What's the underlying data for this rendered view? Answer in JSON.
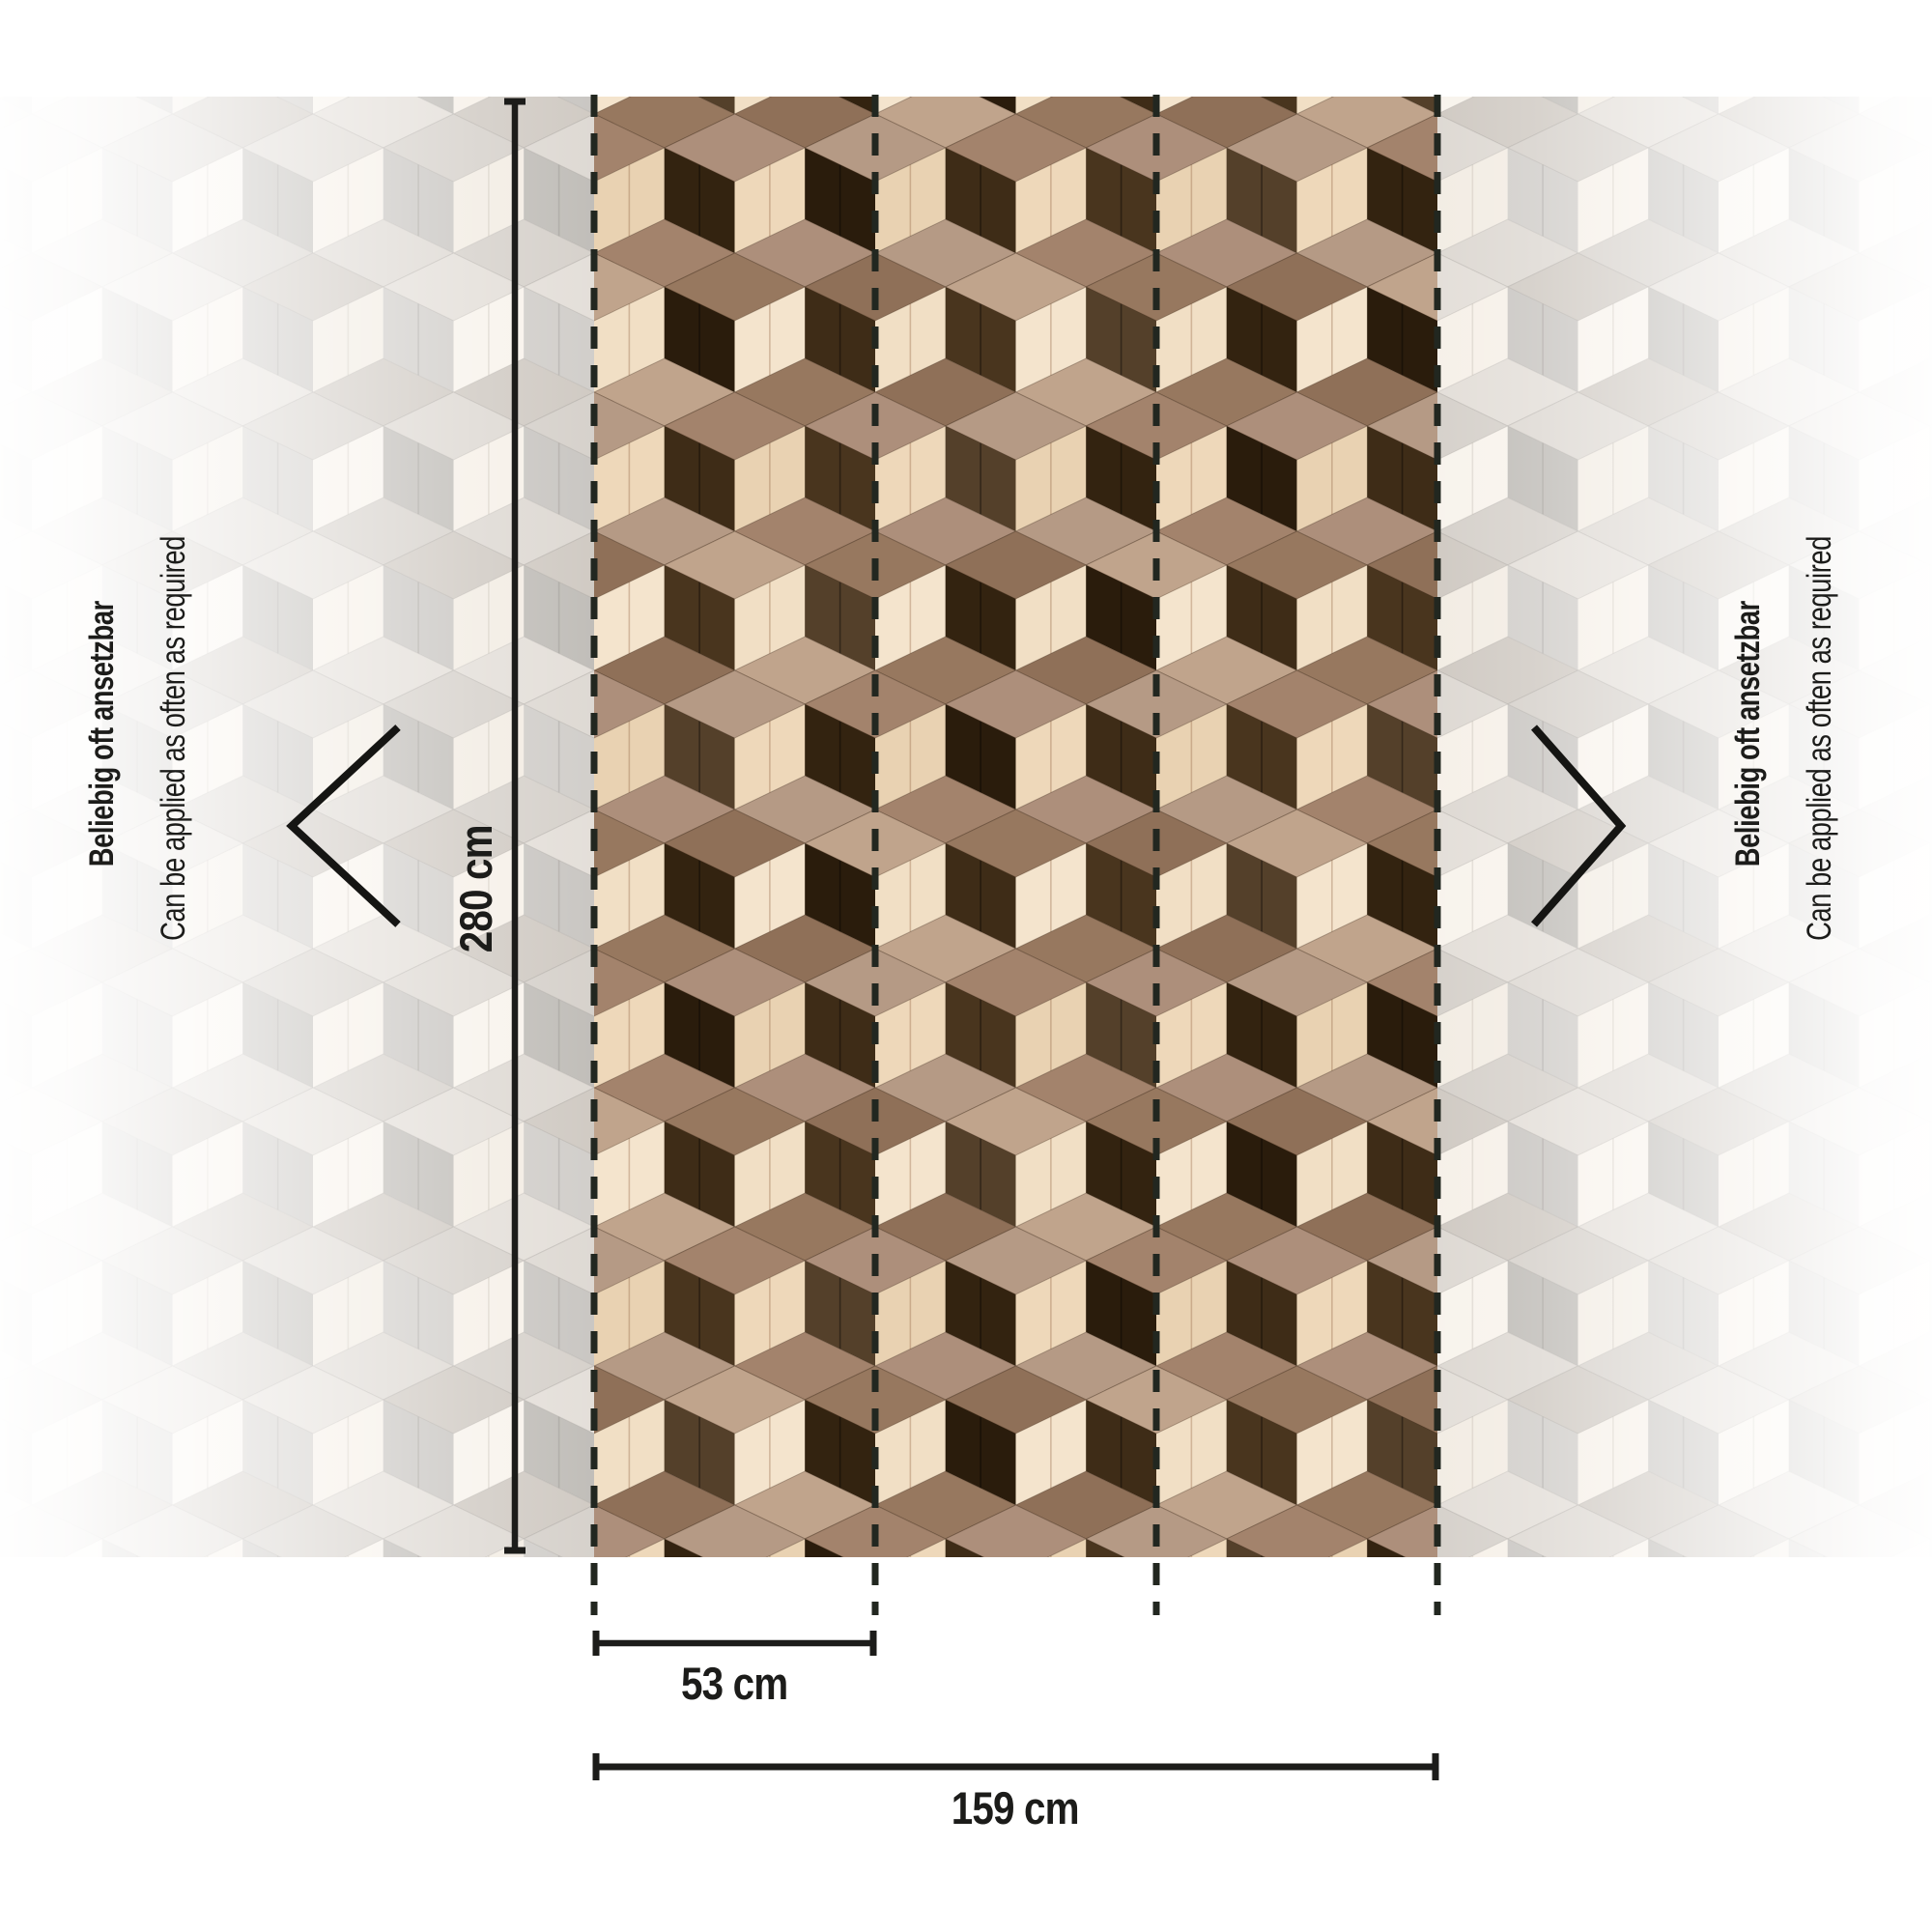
{
  "diagram": {
    "height_label": "280 cm",
    "panel_width_label": "53 cm",
    "total_width_label": "159 cm",
    "note_de": "Beliebig oft ansetzbar",
    "note_en": "Can be applied as often as required"
  },
  "icons": {
    "left": "chevron-left-icon",
    "right": "chevron-right-icon"
  },
  "colors": {
    "ink": "#1c1c1a",
    "dash": "#222720",
    "colored": {
      "tops": [
        "#a3836c",
        "#97785f",
        "#ad8f7b",
        "#8f7058",
        "#b59a85",
        "#c0a48c"
      ],
      "creams": [
        "#f1dfc5",
        "#eed8ba",
        "#f4e4cd",
        "#e9d2b2"
      ],
      "darks": [
        "#3e2c17",
        "#332310",
        "#49351e",
        "#2a1c0c",
        "#54402a"
      ],
      "top_edge": "rgba(60,40,22,0.30)",
      "cream_seam": "rgba(145,100,65,0.35)",
      "dark_seam": "rgba(0,0,0,0.38)"
    },
    "faded": {
      "tops": [
        "#ddd8d2",
        "#e3ded8",
        "#d5d0ca",
        "#cfc9c2"
      ],
      "creams": [
        "#f6f0e8",
        "#f2ece3",
        "#f8f3ec"
      ],
      "darks": [
        "#c8c5c1",
        "#d0cdc9",
        "#bfbcb7"
      ],
      "top_edge": "rgba(140,136,130,0.22)",
      "cream_seam": "rgba(150,140,128,0.22)",
      "dark_seam": "rgba(110,106,100,0.22)"
    }
  }
}
